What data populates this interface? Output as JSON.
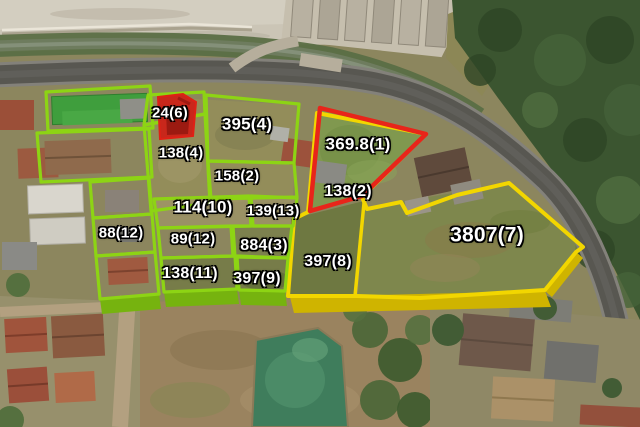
{
  "map": {
    "type": "aerial-cadastral-overlay",
    "colors": {
      "green_boundary": "#8dd414",
      "green_boundary_shade": "#76b30f",
      "yellow_boundary": "#f2d600",
      "yellow_boundary_shade": "#cfb400",
      "red_boundary": "#e8251a",
      "red_marker_fill": "#c9271b",
      "label_text": "#ffffff",
      "label_outline": "#000000"
    }
  },
  "parcels": [
    {
      "label": "24(6)",
      "boundary": "green",
      "marker": "red-filled"
    },
    {
      "label": "395(4)",
      "boundary": "green"
    },
    {
      "label": "138(4)",
      "boundary": "green"
    },
    {
      "label": "158(2)",
      "boundary": "green"
    },
    {
      "label": "369.8(1)",
      "boundary": "red"
    },
    {
      "label": "138(2)",
      "boundary": "red"
    },
    {
      "label": "114(10)",
      "boundary": "green"
    },
    {
      "label": "139(13)",
      "boundary": "green"
    },
    {
      "label": "88(12)",
      "boundary": "green"
    },
    {
      "label": "89(12)",
      "boundary": "green"
    },
    {
      "label": "884(3)",
      "boundary": "green"
    },
    {
      "label": "138(11)",
      "boundary": "green"
    },
    {
      "label": "397(9)",
      "boundary": "green"
    },
    {
      "label": "397(8)",
      "boundary": "yellow"
    },
    {
      "label": "3807(7)",
      "boundary": "yellow"
    }
  ]
}
